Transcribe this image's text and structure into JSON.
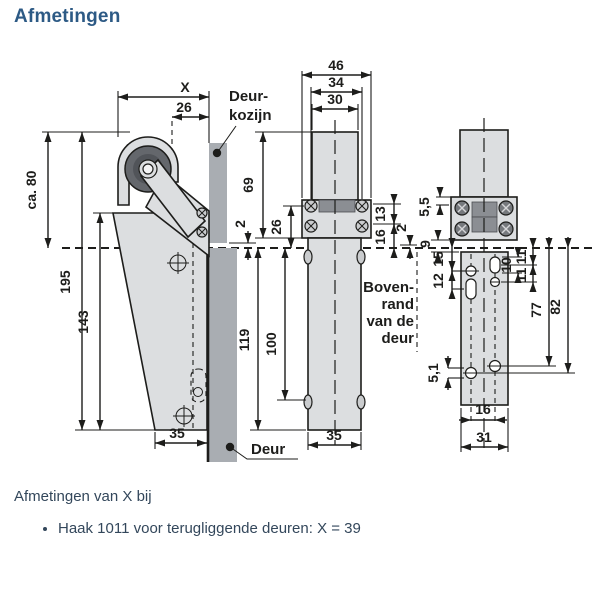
{
  "page": {
    "title": "Afmetingen"
  },
  "footer": {
    "heading": "Afmetingen van X bij",
    "items": [
      "Haak 1011 voor terugliggende deuren: X = 39"
    ]
  },
  "colors": {
    "title": "#2d5a85",
    "body_text": "#33475b",
    "line": "#1d1d1b",
    "light_gray": "#dcdee0",
    "mid_gray": "#a9adb2",
    "dark_gray": "#8b8e93"
  },
  "diagram": {
    "labels": {
      "deurkozijn1": "Deur-",
      "deurkozijn2": "kozijn",
      "deur": "Deur",
      "bovenrand1": "Boven-",
      "bovenrand2": "rand",
      "bovenrand3": "van de",
      "bovenrand4": "deur"
    },
    "dims": {
      "x": "X",
      "d26_frame": "26",
      "ca80": "ca. 80",
      "d195": "195",
      "d143": "143",
      "d35_left": "35",
      "d2_left": "2",
      "d46": "46",
      "d34": "34",
      "d30": "30",
      "d69": "69",
      "d26_mid": "26",
      "d13": "13",
      "d16_mid": "16",
      "d2_mid": "2",
      "d119": "119",
      "d100": "100",
      "d35_mid": "35",
      "d5_5": "5,5",
      "d9": "9",
      "d15": "15",
      "d12": "12",
      "d10": "10",
      "d11_a": "11",
      "d11_b": "11",
      "d77": "77",
      "d82": "82",
      "d5_1": "5,1",
      "d16_right": "16",
      "d31": "31"
    }
  }
}
